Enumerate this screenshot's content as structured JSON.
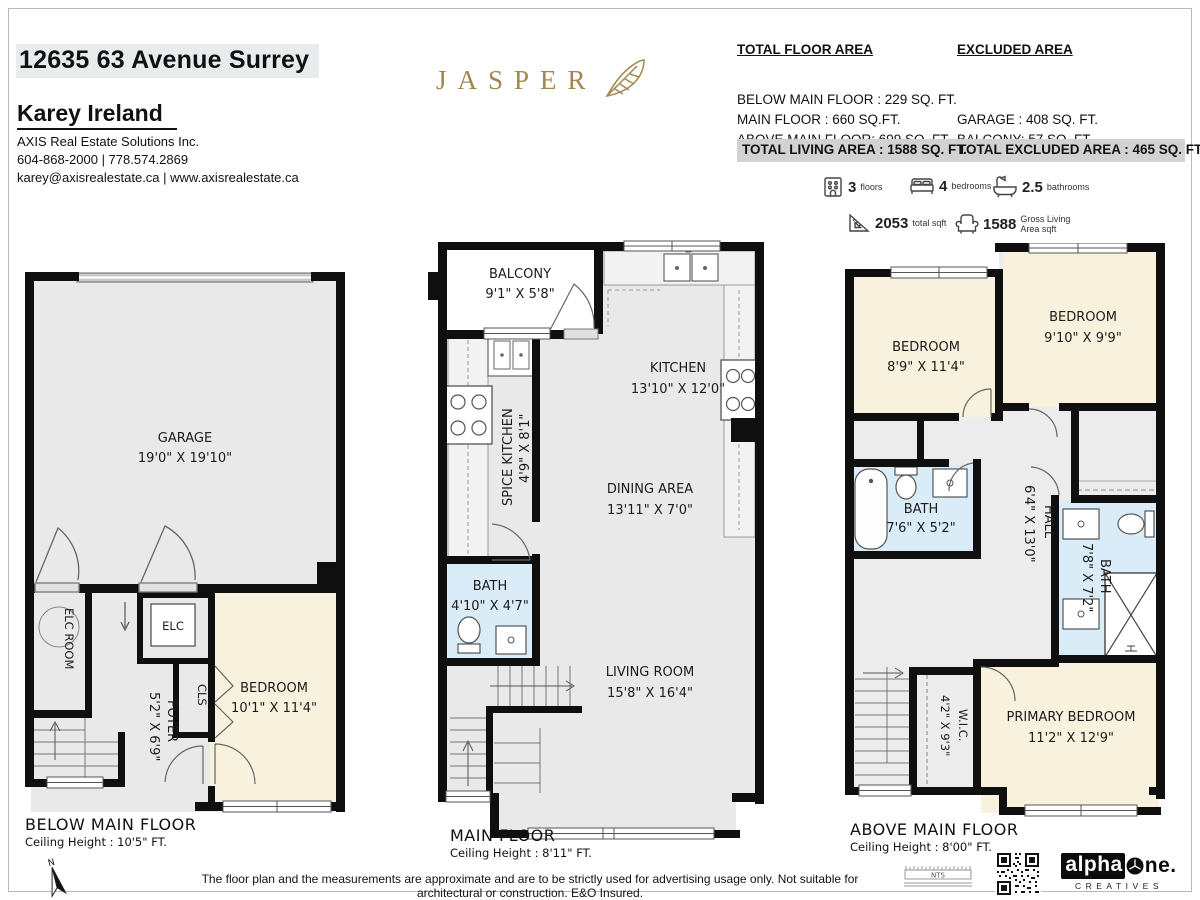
{
  "header": {
    "address": "12635 63 Avenue Surrey",
    "agent": "Karey Ireland",
    "brokerage": "AXIS Real Estate Solutions Inc.",
    "phones": "604-868-2000 | 778.574.2869",
    "emails": "karey@axisrealestate.ca | www.axisrealestate.ca"
  },
  "brand": {
    "logo_text": "JASPER"
  },
  "areas": {
    "total_title": "TOTAL FLOOR AREA",
    "excluded_title": "EXCLUDED AREA",
    "below_line": "BELOW MAIN FLOOR : 229 SQ. FT.",
    "main_line": "MAIN FLOOR : 660 SQ.FT.",
    "above_line": "ABOVE MAIN FLOOR: 699 SQ. FT.",
    "garage_line": "GARAGE : 408 SQ. FT.",
    "balcony_line": "BALCONY: 57 SQ. FT.",
    "total_living": "TOTAL LIVING AREA : 1588 SQ. FT.",
    "total_excluded": "TOTAL EXCLUDED AREA : 465 SQ. FT."
  },
  "stats": {
    "floors": {
      "value": "3",
      "label": "floors"
    },
    "bedrooms": {
      "value": "4",
      "label": "bedrooms"
    },
    "bathrooms": {
      "value": "2.5",
      "label": "bathrooms"
    },
    "total_sqft": {
      "value": "2053",
      "label": "total sqft"
    },
    "gross": {
      "value": "1588",
      "label_line1": "Gross Living",
      "label_line2": "Area sqft"
    }
  },
  "floors": {
    "below": {
      "name": "BELOW MAIN FLOOR",
      "ceiling": "Ceiling Height  : 10'5\" FT.",
      "rooms": {
        "garage": {
          "name": "GARAGE",
          "dims": "19'0\" X 19'10\""
        },
        "elc_room": {
          "name": "ELC ROOM"
        },
        "elc": {
          "name": "ELC"
        },
        "foyer": {
          "name": "FOYER",
          "dims": "5'2\" X 6'9\""
        },
        "cls": {
          "name": "CLS"
        },
        "bedroom": {
          "name": "BEDROOM",
          "dims": "10'1\" X 11'4\""
        }
      }
    },
    "main": {
      "name": "MAIN FLOOR",
      "ceiling": "Ceiling Height : 8'11\" FT.",
      "rooms": {
        "balcony": {
          "name": "BALCONY",
          "dims": "9'1\" X 5'8\""
        },
        "kitchen": {
          "name": "KITCHEN",
          "dims": "13'10\" X 12'0\""
        },
        "spice_kitchen": {
          "name": "SPICE KITCHEN",
          "dims": "4'9\" X 8'1\""
        },
        "bath": {
          "name": "BATH",
          "dims": "4'10\" X 4'7\""
        },
        "dining": {
          "name": "DINING AREA",
          "dims": "13'11\" X 7'0\""
        },
        "living": {
          "name": "LIVING ROOM",
          "dims": "15'8\" X 16'4\""
        }
      }
    },
    "above": {
      "name": "ABOVE MAIN FLOOR",
      "ceiling": "Ceiling Height : 8'00\" FT.",
      "rooms": {
        "bedroom_a": {
          "name": "BEDROOM",
          "dims": "8'9\" X 11'4\""
        },
        "bedroom_b": {
          "name": "BEDROOM",
          "dims": "9'10\" X 9'9\""
        },
        "bath_a": {
          "name": "BATH",
          "dims": "7'6\" X 5'2\""
        },
        "hall": {
          "name": "HALL",
          "dims": "6'4\" X 13'0\""
        },
        "bath_b": {
          "name": "BATH",
          "dims": "7'8\" X 7'2\""
        },
        "wic": {
          "name": "W.I.C.",
          "dims": "4'2\" X 9'3\""
        },
        "primary": {
          "name": "PRIMARY BEDROOM",
          "dims": "11'2\" X 12'9\""
        }
      }
    }
  },
  "footer": {
    "disclaimer": "The floor plan and the measurements are approximate and are to be strictly used for advertising usage only. Not suitable for architectural or construction. E&O Insured.",
    "north": "N",
    "nts": "NTS",
    "alpha_black": "alpha",
    "alpha_rest": "ne.",
    "creatives": "CREATIVES"
  },
  "colors": {
    "wall": "#0f0f0f",
    "room_gray": "#e9e9e9",
    "room_cream": "#f8f1dd",
    "room_blue": "#d9ecf7",
    "brand_gold": "#a2874c",
    "highlight_gray": "#d2d2d2",
    "address_bg": "#e8eced"
  }
}
